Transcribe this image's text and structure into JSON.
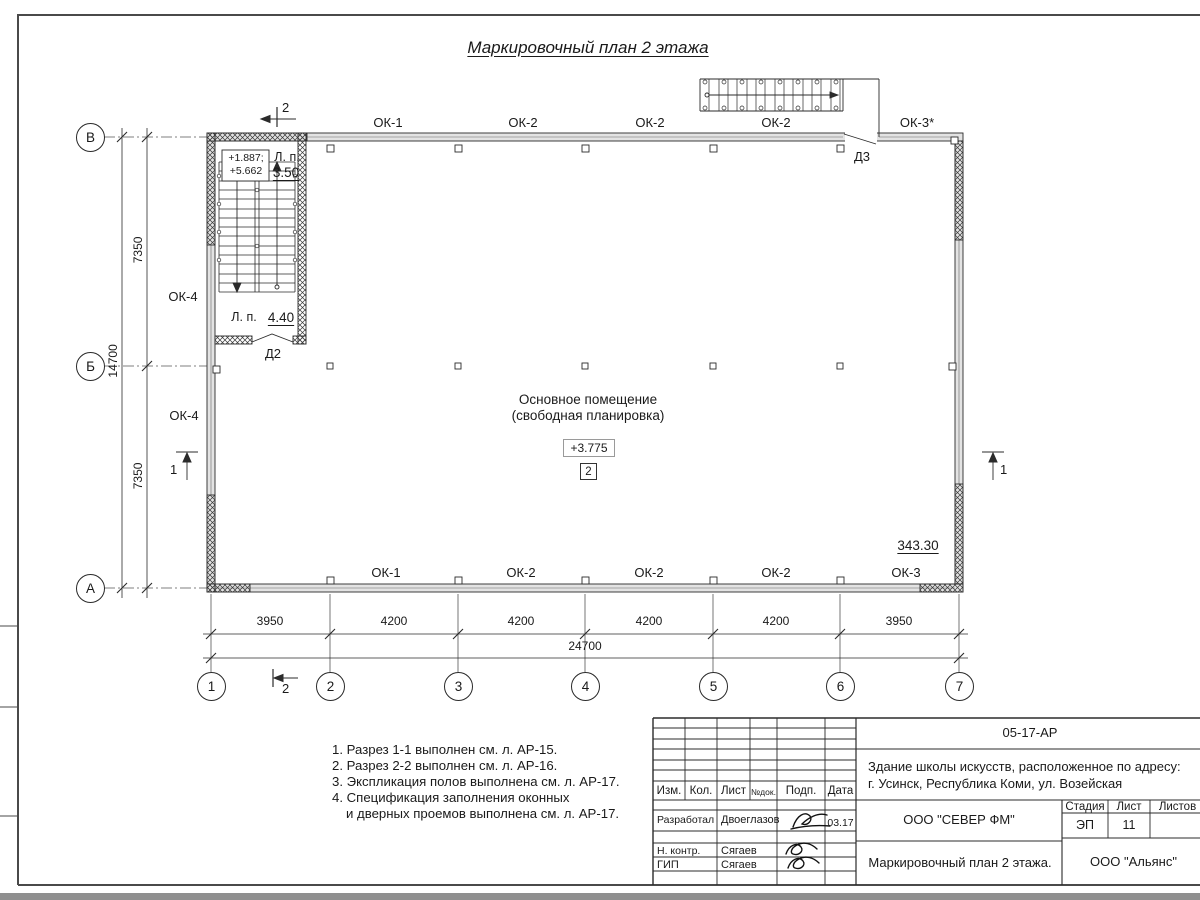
{
  "sheet": {
    "title": "Маркировочный план 2 этажа"
  },
  "plan": {
    "room": {
      "name_line1": "Основное помещение",
      "name_line2": "(свободная планировка)",
      "elevation": "+3.775",
      "number": "2",
      "area": "343.30"
    },
    "stair": {
      "elev_line1": "+1.887;",
      "elev_line2": "+5.662",
      "landing_label_top": "Л. п.",
      "landing_value_top": "3.50",
      "landing_label_mid": "Л. п.",
      "landing_value_mid": "4.40"
    },
    "doors": {
      "d2": "Д2",
      "d3": "Д3"
    },
    "windows": {
      "top": [
        "ОК-1",
        "ОК-2",
        "ОК-2",
        "ОК-2",
        "ОК-3*"
      ],
      "bottom": [
        "ОК-1",
        "ОК-2",
        "ОК-2",
        "ОК-2",
        "ОК-3"
      ],
      "left": [
        "ОК-4",
        "ОК-4"
      ]
    },
    "axes": {
      "cols": [
        "1",
        "2",
        "3",
        "4",
        "5",
        "6",
        "7"
      ],
      "rows": [
        "В",
        "Б",
        "А"
      ]
    },
    "sections": {
      "s1": "1",
      "s2": "2"
    },
    "dims": {
      "bottom": [
        "3950",
        "4200",
        "4200",
        "4200",
        "4200",
        "3950"
      ],
      "bottom_total": "24700",
      "left": [
        "7350",
        "7350"
      ],
      "left_total": "14700"
    }
  },
  "notes": [
    "1. Разрез 1-1 выполнен см. л. АР-15.",
    "2. Разрез 2-2 выполнен см. л. АР-16.",
    "3. Экспликация полов выполнена см. л. АР-17.",
    "4. Спецификация заполнения оконных",
    "и дверных проемов выполнена см. л. АР-17."
  ],
  "titleblock": {
    "doc_number": "05-17-АР",
    "project_line1": "Здание школы искусств, расположенное по адресу:",
    "project_line2": "г. Усинск, Республика Коми, ул. Возейская",
    "cols": [
      "Изм.",
      "Кол.",
      "Лист",
      "№док.",
      "Подп.",
      "Дата"
    ],
    "company": "ООО \"СЕВЕР ФМ\"",
    "drawing_title": "Маркировочный план 2 этажа.",
    "contractor": "ООО \"Альянс\"",
    "stage_label": "Стадия",
    "sheet_label": "Лист",
    "sheets_label": "Листов",
    "stage": "ЭП",
    "sheet_number": "11",
    "signers": [
      {
        "role": "Разработал",
        "name": "Двоеглазов",
        "date": "03.17"
      },
      {
        "role": "Н. контр.",
        "name": "Сягаев",
        "date": ""
      },
      {
        "role": "ГИП",
        "name": "Сягаев",
        "date": ""
      }
    ]
  }
}
